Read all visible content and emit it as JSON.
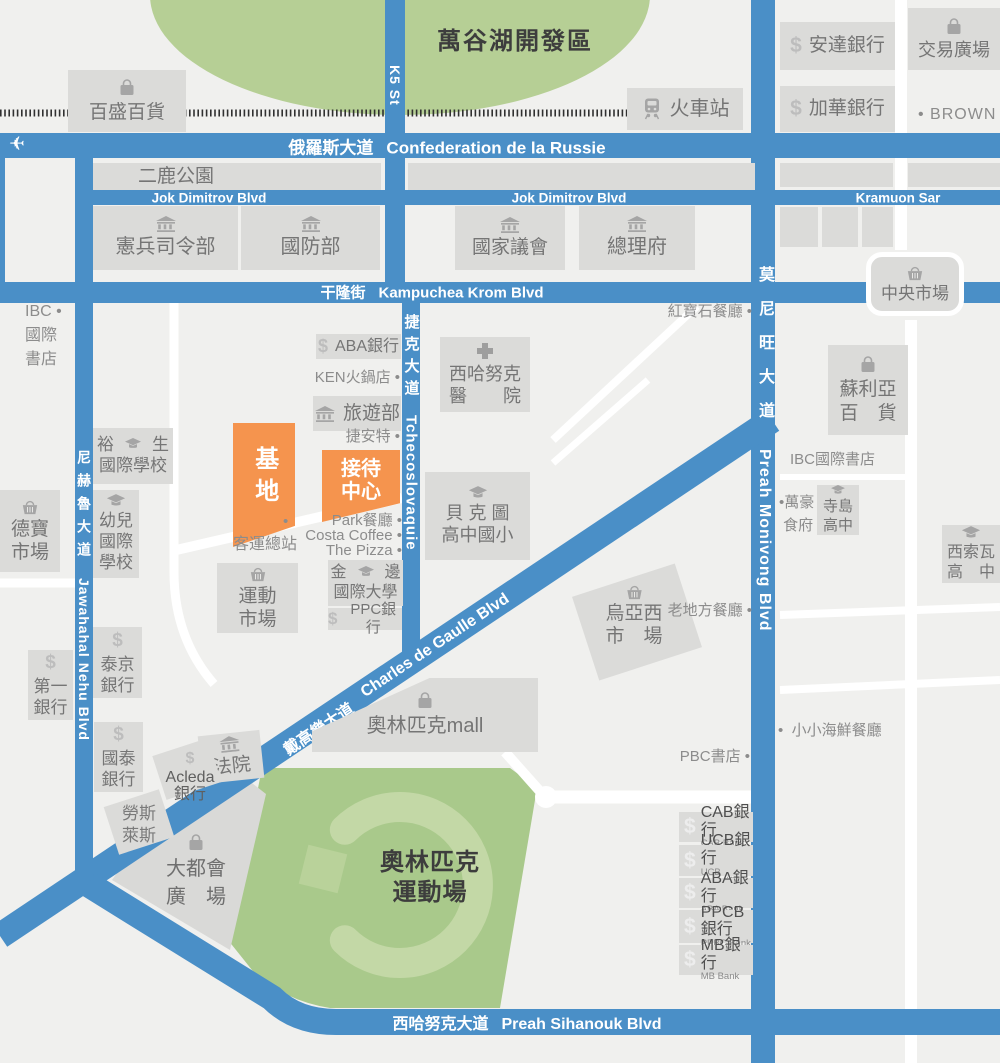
{
  "canvas": {
    "width": 1000,
    "height": 1063
  },
  "colors": {
    "bg": "#F0F0EE",
    "road_blue": "#4A8FC7",
    "building": "#DBDBD9",
    "building_text": "#757575",
    "icon_gray": "#A5A5A5",
    "lake_green": "#B6CF95",
    "stadium_green": "#A9C98B",
    "stadium_ring": "#C3D8A6",
    "stadium_square": "#B9D29A",
    "orange": "#F5944E",
    "poi_text": "#8C8C8C",
    "dark_text": "#3D3D3D",
    "railway": "#303030"
  },
  "area_labels": [
    {
      "id": "lake-dev-zone-label",
      "x": 515,
      "y": 27,
      "size": 24,
      "lh": 30,
      "ls": 2,
      "lines": [
        "萬谷湖開發區"
      ]
    },
    {
      "id": "olympic-stadium-label",
      "x": 430,
      "y": 848,
      "size": 24,
      "lh": 30,
      "ls": 1,
      "lines": [
        "奧林匹克",
        "運動場"
      ]
    }
  ],
  "road_labels_h": [
    {
      "id": "russie-blvd",
      "zh": "俄羅斯大道",
      "en": "Confederation de la Russie",
      "x": 447,
      "y": 146,
      "size": 17
    },
    {
      "id": "jok-dimitrov-west",
      "zh": "",
      "en": "Jok Dimitrov Blvd",
      "x": 209,
      "y": 198,
      "size": 13.5
    },
    {
      "id": "jok-dimitrov-east",
      "zh": "",
      "en": "Jok Dimitrov Blvd",
      "x": 569,
      "y": 198,
      "size": 13.5
    },
    {
      "id": "kramuon-sar",
      "zh": "",
      "en": "Kramuon Sar",
      "x": 898,
      "y": 198,
      "size": 13.5
    },
    {
      "id": "kampuchea-krom",
      "zh": "干隆街",
      "en": "Kampuchea Krom Blvd",
      "x": 432,
      "y": 292,
      "size": 15
    },
    {
      "id": "sihanouk-blvd",
      "zh": "西哈努克大道",
      "en": "Preah Sihanouk Blvd",
      "x": 527,
      "y": 1022,
      "size": 16
    }
  ],
  "road_labels_d": [
    {
      "id": "charles-de-gaulle",
      "zh": "戴高樂大道",
      "en": "Charles de Gaulle Blvd",
      "x": 397,
      "y": 675,
      "size": 16
    }
  ],
  "road_labels_v": [
    {
      "id": "k5-st",
      "zh": "",
      "en": "K5 St",
      "x": 395,
      "y": 52,
      "size": 14,
      "ls": 0
    },
    {
      "id": "tchecoslovaquie",
      "zh": "捷克大道",
      "en": "Tchecoslovaquie",
      "x": 411,
      "y": 314,
      "size": 15,
      "ls": 7
    },
    {
      "id": "monivong",
      "zh": "莫尼旺大道",
      "en": "Preah Monivong Blvd",
      "x": 764,
      "y": 266,
      "size": 16,
      "ls": 18
    },
    {
      "id": "nehru",
      "zh": "尼赫魯大道",
      "en": "Jawahahal Nehu Blvd",
      "x": 84,
      "y": 450,
      "size": 14,
      "ls": 9
    }
  ],
  "site_markers": [
    {
      "id": "site-base",
      "x": 233,
      "y": 423,
      "w": 62,
      "h": 110,
      "size": 24,
      "vertical": true,
      "clip": "polygon(0 0,100% 0,100% 83%,0 100%)",
      "lines": [
        "基地"
      ]
    },
    {
      "id": "reception-center",
      "x": 322,
      "y": 450,
      "w": 78,
      "h": 62,
      "size": 20,
      "vertical": false,
      "clip": "polygon(0 0,100% 0,100% 74%,0 100%)",
      "lines": [
        "接待",
        "中心"
      ]
    }
  ],
  "buildings": [
    {
      "id": "baisheng-dept-store",
      "x": 68,
      "y": 70,
      "w": 118,
      "h": 62,
      "icon": "bag",
      "layout": "col",
      "size": 19,
      "lines": [
        "百盛百貨"
      ]
    },
    {
      "id": "train-station",
      "x": 627,
      "y": 88,
      "w": 116,
      "h": 42,
      "icon": "train",
      "layout": "row",
      "size": 20,
      "lines": [
        "火車站"
      ]
    },
    {
      "id": "erlu-park",
      "x": 93,
      "y": 163,
      "w": 288,
      "h": 27,
      "layout": "plain",
      "size": 19,
      "pad": 45,
      "lines": [
        "二鹿公園"
      ]
    },
    {
      "id": "block-a",
      "x": 408,
      "y": 163,
      "w": 347,
      "h": 27,
      "layout": "col",
      "lines": []
    },
    {
      "id": "block-b",
      "x": 780,
      "y": 163,
      "w": 113,
      "h": 24,
      "layout": "col",
      "lines": []
    },
    {
      "id": "block-c",
      "x": 908,
      "y": 163,
      "w": 92,
      "h": 24,
      "layout": "col",
      "lines": []
    },
    {
      "id": "gendarmerie-hq",
      "x": 93,
      "y": 206,
      "w": 145,
      "h": 64,
      "icon": "bank",
      "layout": "col",
      "size": 20,
      "lines": [
        "憲兵司令部"
      ]
    },
    {
      "id": "defense-ministry",
      "x": 241,
      "y": 206,
      "w": 139,
      "h": 64,
      "icon": "bank",
      "layout": "col",
      "size": 20,
      "lines": [
        "國防部"
      ]
    },
    {
      "id": "national-assembly",
      "x": 455,
      "y": 206,
      "w": 110,
      "h": 64,
      "icon": "bank",
      "layout": "col",
      "size": 19,
      "lines": [
        "國家議會"
      ]
    },
    {
      "id": "prime-minister-office",
      "x": 579,
      "y": 206,
      "w": 116,
      "h": 64,
      "icon": "bank",
      "layout": "col",
      "size": 20,
      "lines": [
        "總理府"
      ]
    },
    {
      "id": "block-d",
      "x": 780,
      "y": 207,
      "w": 38,
      "h": 40,
      "layout": "col",
      "lines": []
    },
    {
      "id": "block-e",
      "x": 822,
      "y": 207,
      "w": 36,
      "h": 40,
      "layout": "col",
      "lines": []
    },
    {
      "id": "block-f",
      "x": 862,
      "y": 207,
      "w": 31,
      "h": 40,
      "layout": "col",
      "lines": []
    },
    {
      "id": "anda-bank",
      "x": 780,
      "y": 22,
      "w": 115,
      "h": 48,
      "icon": "dollar",
      "layout": "row",
      "size": 19,
      "lines": [
        "安達銀行"
      ]
    },
    {
      "id": "jiahua-bank",
      "x": 780,
      "y": 86,
      "w": 115,
      "h": 46,
      "icon": "dollar",
      "layout": "row",
      "size": 19,
      "lines": [
        "加華銀行"
      ]
    },
    {
      "id": "trade-plaza",
      "x": 908,
      "y": 8,
      "w": 92,
      "h": 62,
      "icon": "bag",
      "layout": "col",
      "size": 18,
      "lines": [
        "交易廣場"
      ]
    },
    {
      "id": "central-market",
      "x": 866,
      "y": 252,
      "w": 98,
      "h": 64,
      "icon": "basket",
      "layout": "col",
      "size": 17,
      "variant": "rounded",
      "lines": [
        "中央市場"
      ]
    },
    {
      "id": "soriya-dept-store",
      "x": 828,
      "y": 345,
      "w": 80,
      "h": 90,
      "icon": "bag",
      "layout": "col",
      "size": 19,
      "lines": [
        "蘇利亞",
        "百　貨"
      ]
    },
    {
      "id": "aba-bank-mid",
      "x": 316,
      "y": 334,
      "w": 85,
      "h": 25,
      "icon": "dollar",
      "layout": "row",
      "size": 16,
      "lines": [
        "ABA銀行"
      ]
    },
    {
      "id": "tourism-ministry",
      "x": 313,
      "y": 396,
      "w": 88,
      "h": 35,
      "icon": "bank",
      "layout": "row",
      "size": 19,
      "lines": [
        "旅遊部"
      ]
    },
    {
      "id": "sihanouk-hospital",
      "x": 440,
      "y": 337,
      "w": 90,
      "h": 75,
      "icon": "cross",
      "layout": "col",
      "size": 18,
      "lines": [
        "西哈努克",
        "醫　　院"
      ]
    },
    {
      "id": "bak-touk-school",
      "x": 425,
      "y": 472,
      "w": 105,
      "h": 88,
      "icon": "cap",
      "layout": "col",
      "size": 18,
      "lines": [
        "貝 克 圖",
        "高中國小"
      ]
    },
    {
      "id": "yusheng-intl-school",
      "x": 93,
      "y": 428,
      "w": 80,
      "h": 56,
      "icon": "cap",
      "layout": "icon-mid",
      "size": 17,
      "lines": [
        "裕",
        "生",
        "國際學校"
      ]
    },
    {
      "id": "kindergarten-intl-school",
      "x": 93,
      "y": 490,
      "w": 46,
      "h": 88,
      "icon": "cap",
      "layout": "col",
      "size": 17,
      "lines": [
        "幼兒",
        "國際",
        "學校"
      ]
    },
    {
      "id": "debao-market",
      "x": 0,
      "y": 490,
      "w": 60,
      "h": 82,
      "icon": "basket",
      "layout": "col",
      "size": 19,
      "lines": [
        "德寶",
        "市場"
      ]
    },
    {
      "id": "first-bank",
      "x": 28,
      "y": 650,
      "w": 45,
      "h": 70,
      "icon": "dollar",
      "layout": "col",
      "size": 17,
      "lines": [
        "第一",
        "銀行"
      ]
    },
    {
      "id": "taijing-bank",
      "x": 93,
      "y": 627,
      "w": 49,
      "h": 71,
      "icon": "dollar",
      "layout": "col",
      "size": 17,
      "lines": [
        "泰京",
        "銀行"
      ]
    },
    {
      "id": "guotai-bank",
      "x": 94,
      "y": 722,
      "w": 49,
      "h": 70,
      "icon": "dollar",
      "layout": "col",
      "size": 17,
      "lines": [
        "國泰",
        "銀行"
      ]
    },
    {
      "id": "courthouse",
      "x": 200,
      "y": 733,
      "w": 62,
      "h": 48,
      "icon": "bank",
      "layout": "col",
      "size": 19,
      "rot": -6,
      "lines": [
        "法院"
      ]
    },
    {
      "id": "acleda-box",
      "x": 158,
      "y": 746,
      "w": 58,
      "h": 46,
      "layout": "col",
      "rot": -18,
      "lines": []
    },
    {
      "id": "rolls-royce-box",
      "x": 110,
      "y": 797,
      "w": 58,
      "h": 50,
      "layout": "col",
      "rot": -18,
      "lines": []
    },
    {
      "id": "olympic-mall",
      "x": 312,
      "y": 678,
      "w": 226,
      "h": 74,
      "icon": "bag",
      "layout": "col",
      "size": 20,
      "clip": "polygon(0 72%, 52% 0, 100% 0, 100% 100%, 0 100%)",
      "lines": [
        "奧林匹克mall"
      ]
    },
    {
      "id": "uyaxi-market-box",
      "x": 583,
      "y": 578,
      "w": 108,
      "h": 88,
      "layout": "col",
      "rot": -18,
      "lines": []
    },
    {
      "id": "sports-market",
      "x": 217,
      "y": 563,
      "w": 81,
      "h": 70,
      "icon": "basket",
      "layout": "col",
      "size": 19,
      "lines": [
        "運動",
        "市場"
      ]
    },
    {
      "id": "pp-intl-university",
      "x": 328,
      "y": 560,
      "w": 75,
      "h": 46,
      "icon": "cap",
      "layout": "icon-mid",
      "size": 16,
      "lines": [
        "金",
        "邊",
        "國際大學"
      ]
    },
    {
      "id": "ppc-bank",
      "x": 328,
      "y": 608,
      "w": 74,
      "h": 22,
      "icon": "dollar",
      "layout": "row",
      "size": 15,
      "lines": [
        "PPC銀行"
      ]
    },
    {
      "id": "cab-bank",
      "x": 679,
      "y": 812,
      "w": 74,
      "h": 30,
      "layout": "bank",
      "size": 16,
      "lines": [
        "CAB銀行",
        "CAB Bank"
      ]
    },
    {
      "id": "ucb-bank",
      "x": 679,
      "y": 845,
      "w": 74,
      "h": 31,
      "layout": "bank",
      "size": 16,
      "lines": [
        "UCB銀行",
        "UCB Bank(總部)"
      ]
    },
    {
      "id": "aba-bank-south",
      "x": 679,
      "y": 878,
      "w": 74,
      "h": 30,
      "layout": "bank",
      "size": 16,
      "lines": [
        "ABA銀行",
        "ABA Bank"
      ]
    },
    {
      "id": "ppcb-bank",
      "x": 679,
      "y": 910,
      "w": 74,
      "h": 33,
      "layout": "bank",
      "size": 16,
      "lines": [
        "PPCB銀行",
        "PPBC Bank"
      ]
    },
    {
      "id": "mb-bank",
      "x": 679,
      "y": 945,
      "w": 74,
      "h": 30,
      "layout": "bank",
      "size": 16,
      "lines": [
        "MB銀行",
        "MB Bank"
      ]
    },
    {
      "id": "terashima-high-school",
      "x": 817,
      "y": 485,
      "w": 42,
      "h": 50,
      "icon": "cap",
      "layout": "col",
      "size": 15,
      "lines": [
        "寺島",
        "高中"
      ]
    },
    {
      "id": "sisowath-high-school",
      "x": 942,
      "y": 525,
      "w": 58,
      "h": 58,
      "icon": "cap",
      "layout": "col",
      "size": 16,
      "lines": [
        "西索瓦",
        "高　中"
      ]
    }
  ],
  "poi_labels": [
    {
      "id": "ibc-bookstore-west",
      "x": 25,
      "y": 300,
      "align": "left",
      "size": 16,
      "lh": 24,
      "lines": [
        "IBC •",
        "國際",
        "書店"
      ]
    },
    {
      "id": "ken-hotpot",
      "x": 400,
      "y": 369,
      "align": "right",
      "size": 15,
      "lh": 17,
      "lines": [
        "KEN火鍋店 •"
      ]
    },
    {
      "id": "giant-bike-shop",
      "x": 400,
      "y": 428,
      "align": "right",
      "size": 15,
      "lh": 17,
      "lines": [
        "捷安特 •"
      ]
    },
    {
      "id": "bus-terminal",
      "x": 233,
      "y": 536,
      "align": "left",
      "size": 16,
      "lh": 18,
      "lines": [
        "客運總站"
      ]
    },
    {
      "id": "bus-terminal-dot",
      "x": 283,
      "y": 514,
      "align": "left",
      "size": 15,
      "lh": 15,
      "lines": [
        "•"
      ]
    },
    {
      "id": "park-restaurant",
      "x": 402,
      "y": 513,
      "align": "right",
      "size": 15,
      "lh": 16,
      "lines": [
        "Park餐廳 •"
      ]
    },
    {
      "id": "costa-coffee",
      "x": 402,
      "y": 528,
      "align": "right",
      "size": 15,
      "lh": 16,
      "lines": [
        "Costa Coffee •"
      ]
    },
    {
      "id": "the-pizza",
      "x": 402,
      "y": 543,
      "align": "right",
      "size": 15,
      "lh": 16,
      "lines": [
        "The Pizza •"
      ]
    },
    {
      "id": "ruby-restaurant",
      "x": 752,
      "y": 303,
      "align": "right",
      "size": 15,
      "lh": 17,
      "lines": [
        "紅寶石餐廳 •"
      ]
    },
    {
      "id": "old-place-restaurant",
      "x": 752,
      "y": 602,
      "align": "right",
      "size": 15,
      "lh": 17,
      "lines": [
        "老地方餐廳 •"
      ]
    },
    {
      "id": "little-seafood-restaurant",
      "x": 778,
      "y": 722,
      "align": "left",
      "size": 15,
      "lh": 17,
      "lines": [
        "•  小小海鮮餐廳"
      ]
    },
    {
      "id": "pbc-bookstore",
      "x": 750,
      "y": 748,
      "align": "right",
      "size": 15,
      "lh": 17,
      "lines": [
        "PBC書店 •"
      ]
    },
    {
      "id": "brown-label",
      "x": 918,
      "y": 106,
      "align": "left",
      "size": 16,
      "lh": 18,
      "ls": 1,
      "lines": [
        "• BROWN"
      ]
    },
    {
      "id": "ibc-bookstore-east",
      "x": 790,
      "y": 451,
      "align": "left",
      "size": 15,
      "lh": 17,
      "lines": [
        "IBC國際書店"
      ]
    },
    {
      "id": "wanhao-restaurant",
      "x": 779,
      "y": 491,
      "align": "left",
      "size": 15,
      "lh": 23,
      "lines": [
        "•萬豪",
        " 食府"
      ]
    },
    {
      "id": "acleda-bank",
      "x": 190,
      "y": 750,
      "align": "center",
      "icon": "dollar",
      "size": 16,
      "lh": 17,
      "color": "#5F5F5F",
      "lines": [
        "Acleda",
        "銀行"
      ]
    },
    {
      "id": "rolls-royce",
      "x": 139,
      "y": 803,
      "align": "center",
      "size": 17,
      "lh": 22,
      "color": "#7A7A7A",
      "lines": [
        "勞斯",
        "萊斯"
      ]
    },
    {
      "id": "uyaxi-market",
      "x": 634,
      "y": 583,
      "align": "center",
      "icon": "basket",
      "size": 19,
      "lh": 23,
      "color": "#757575",
      "lines": [
        "烏亞西",
        "市　場"
      ]
    },
    {
      "id": "metro-plaza",
      "x": 196,
      "y": 833,
      "align": "center",
      "icon": "bag",
      "size": 20,
      "lh": 28,
      "color": "#6F6F6F",
      "lines": [
        "大都會",
        "廣　場"
      ]
    }
  ],
  "markers": {
    "airplane": {
      "x": 9,
      "y": 133
    }
  }
}
